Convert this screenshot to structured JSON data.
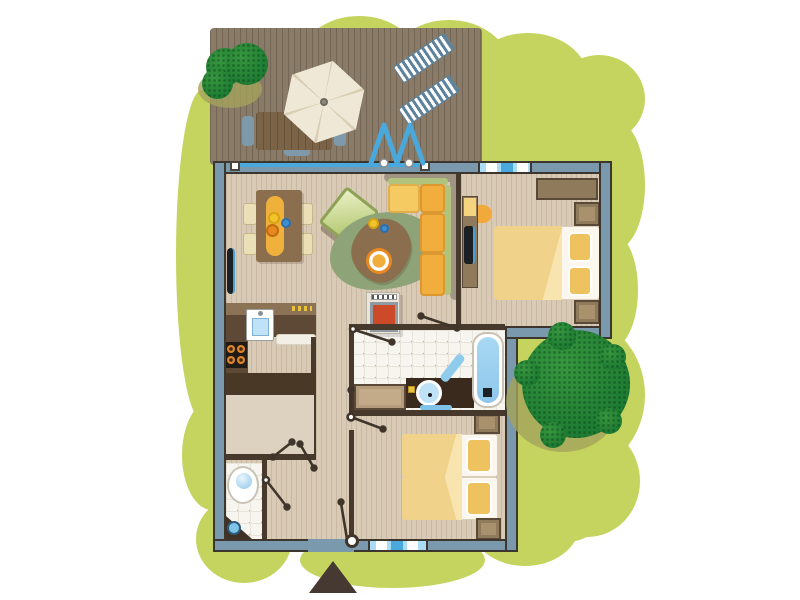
{
  "scene": {
    "kind": "holiday-cottage-floor-plan-illustration",
    "visible_text": [],
    "marker": "entrance-triangle"
  },
  "palette": {
    "grass": "#c4d45e",
    "deck": "#8a7b68",
    "floor": "#d9cab6",
    "tile": "#f7f5ef",
    "tile_line": "#e8e4da",
    "tile_dot": "#b9b2a4",
    "wall": "#7b99ac",
    "wall_edge": "#3d362f",
    "iwall": "#473a2c",
    "wood": "#8f7a5c",
    "wood_dark": "#5a4936",
    "wood_light": "#a8916c",
    "glass": "#49a8dc",
    "window_bg": "#aadcf6",
    "tree": "#1f7c33",
    "tree_light": "#38973f",
    "tree_shadow": "#a4a35b",
    "umbrella": "#efe8d6",
    "umbrella_dark": "#d9cdb2",
    "lounger": "#5d829c",
    "sofa_orange": "#f2ae3c",
    "sofa_yellow": "#f6ca62",
    "sofa_back": "#a09483",
    "sofa_green": "#b2c37e",
    "duvet": "#f1d28a",
    "duvet_fold": "#f8e4ae",
    "pillow": "#eec35f",
    "bed_white": "#fbf7ee",
    "runner": "#f0b13c",
    "chair_cream": "#eadfb6",
    "rug": "#8ea478",
    "table_brown": "#8a6e4e",
    "plate": "#e8891f",
    "stove_red": "#cd4a28",
    "frame_gray": "#8f9ba1",
    "unit_cream": "#e9e5da",
    "cooktop": "#211b15",
    "burner": "#e08428",
    "counter_top": "#8c7356",
    "counter_dark": "#5d4936",
    "counter_deep": "#4a3827",
    "sink_blue": "#bfe2f6",
    "bath_blue": "#a9d9f4",
    "mat_blue": "#7fc3e8",
    "black": "#1c2024",
    "tv_blue": "#4aa0d0",
    "storage_floor": "#ddd2bf",
    "marker": "#463931",
    "door_line": "#3f352b"
  },
  "outdoor": {
    "deck_items": [
      "small-tree",
      "parasol",
      "picnic-table",
      "bench",
      "bench",
      "bench",
      "sun-lounger",
      "sun-lounger",
      "folding-glass-door"
    ],
    "garden_items": [
      "lawn",
      "large-tree"
    ]
  },
  "rooms": {
    "living_room": {
      "furniture": [
        "dining-table",
        "dining-chairs-x4",
        "table-decor",
        "armchair",
        "rug",
        "coffee-table",
        "corner-sofa",
        "wood-stove",
        "radiator"
      ]
    },
    "kitchen": {
      "furniture": [
        "counter",
        "sink",
        "cooktop-4-burners",
        "dishwasher",
        "drawer-handles"
      ]
    },
    "bedroom_main": {
      "furniture": [
        "double-bed",
        "pillows-x2",
        "nightstand",
        "nightstand",
        "wardrobe",
        "desk",
        "chair",
        "tv"
      ]
    },
    "bathroom": {
      "furniture": [
        "bathtub",
        "vanity-sink",
        "round-mirror",
        "towel",
        "bath-mat",
        "dresser"
      ]
    },
    "bedroom_twin": {
      "furniture": [
        "single-bed",
        "single-bed",
        "nightstand",
        "nightstand"
      ]
    },
    "wc": {
      "furniture": [
        "toilet",
        "corner-washbasin"
      ]
    },
    "storage": {
      "furniture": []
    }
  },
  "openings": [
    "sliding-door-track",
    "folding-glass-door",
    "window-bedroom-main",
    "window-bottom",
    "front-door",
    "door-swing-x7"
  ]
}
